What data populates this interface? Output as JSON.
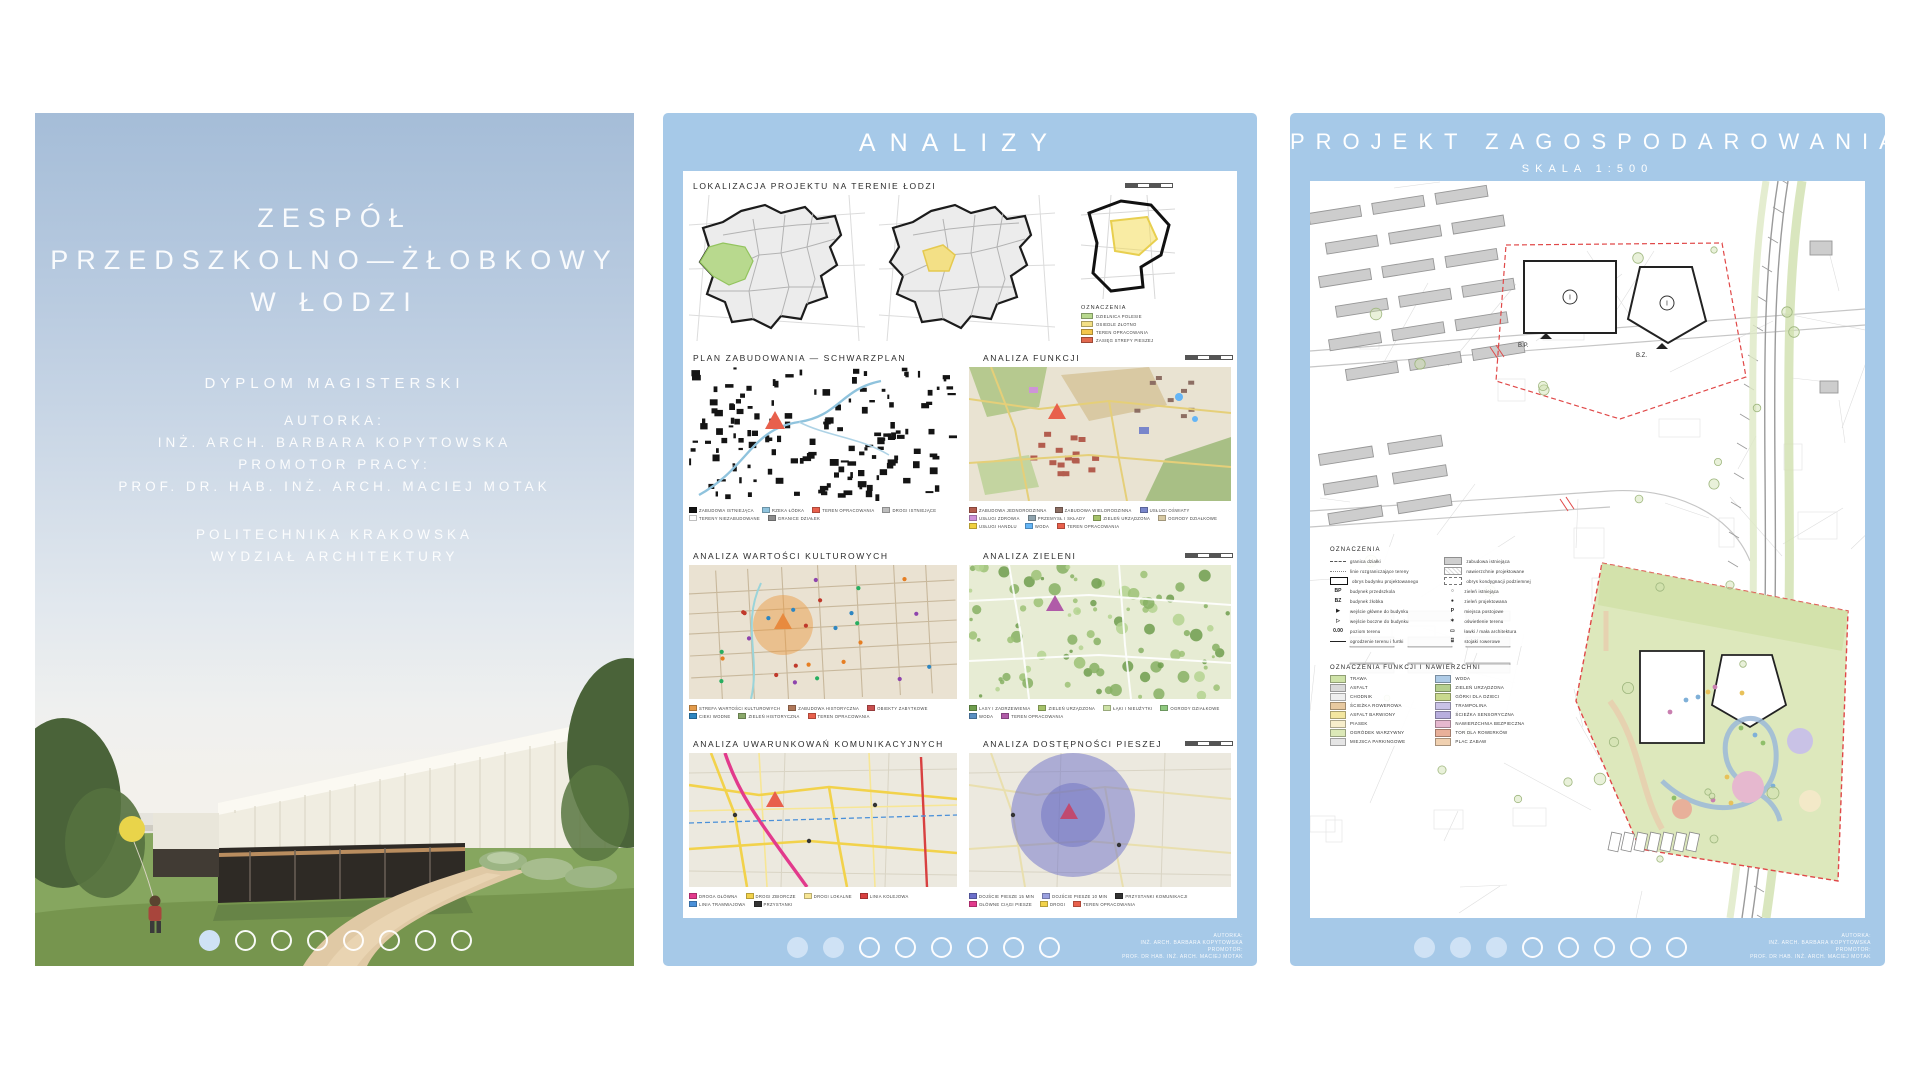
{
  "app": {
    "accent_blue": "#a6c9e8",
    "dot_active": "#cfe2f5",
    "paper": "#ffffff"
  },
  "pagination": {
    "count": 8
  },
  "board1": {
    "title_lines": [
      "ZESPÓŁ",
      "PRZEDSZKOLNO—ŻŁOBKOWY",
      "W ŁODZI"
    ],
    "degree": "DYPLOM MAGISTERSKI",
    "author_label": "AUTORKA:",
    "author": "INŻ. ARCH. BARBARA KOPYTOWSKA",
    "promoter_label": "PROMOTOR PRACY:",
    "promoter": "PROF. DR. HAB. INŻ. ARCH. MACIEJ MOTAK",
    "university": "POLITECHNIKA KRAKOWSKA",
    "faculty": "WYDZIAŁ ARCHITEKTURY",
    "page": 1
  },
  "board2": {
    "title": "ANALIZY",
    "page": 2,
    "loc": {
      "title": "LOKALIZACJA PROJEKTU NA TERENIE ŁODZI",
      "legend_title": "OZNACZENIA",
      "legend": [
        {
          "c": "#b8d98e",
          "t": "DZIELNICA POLESIE"
        },
        {
          "c": "#f3e086",
          "t": "OSIEDLE ZŁOTNO"
        },
        {
          "c": "#f4c64d",
          "t": "TEREN OPRACOWANIA"
        },
        {
          "c": "#e2694f",
          "t": "ZASIĘG STREFY PIESZEJ"
        }
      ]
    },
    "maps": [
      {
        "title": "PLAN ZABUDOWANIA — SCHWARZPLAN",
        "legend": [
          {
            "c": "#141414",
            "t": "ZABUDOWA ISTNIEJĄCA"
          },
          {
            "c": "#8fc3dd",
            "t": "RZEKA ŁÓDKA"
          },
          {
            "c": "#e8604c",
            "t": "TEREN OPRACOWANIA"
          },
          {
            "c": "#bdbdbd",
            "t": "DROGI ISTNIEJĄCE"
          },
          {
            "c": "#ffffff",
            "t": "TERENY NIEZABUDOWANE"
          },
          {
            "c": "#8d8d8d",
            "t": "GRANICE DZIAŁEK"
          }
        ]
      },
      {
        "title": "ANALIZA FUNKCJI",
        "legend": [
          {
            "c": "#b35d4e",
            "t": "ZABUDOWA JEDNORODZINNA"
          },
          {
            "c": "#8d6e63",
            "t": "ZABUDOWA WIELORODZINNA"
          },
          {
            "c": "#7986cb",
            "t": "USŁUGI OŚWIATY"
          },
          {
            "c": "#ce93d8",
            "t": "USŁUGI ZDROWIA"
          },
          {
            "c": "#90a4ae",
            "t": "PRZEMYSŁ I SKŁADY"
          },
          {
            "c": "#a5c26a",
            "t": "ZIELEŃ URZĄDZONA"
          },
          {
            "c": "#d7c9a3",
            "t": "OGRODY DZIAŁKOWE"
          },
          {
            "c": "#f0d040",
            "t": "USŁUGI HANDLU"
          },
          {
            "c": "#64b5f6",
            "t": "WODA"
          },
          {
            "c": "#e8604c",
            "t": "TEREN OPRACOWANIA"
          }
        ]
      },
      {
        "title": "ANALIZA WARTOŚCI KULTUROWYCH",
        "legend": [
          {
            "c": "#e39b4b",
            "t": "STREFA WARTOŚCI KULTUROWYCH"
          },
          {
            "c": "#b0785a",
            "t": "ZABUDOWA HISTORYCZNA"
          },
          {
            "c": "#c94f4f",
            "t": "OBIEKTY ZABYTKOWE"
          },
          {
            "c": "#2e86c1",
            "t": "CIEKI WODNE"
          },
          {
            "c": "#8aa86a",
            "t": "ZIELEŃ HISTORYCZNA"
          },
          {
            "c": "#e8604c",
            "t": "TEREN OPRACOWANIA"
          }
        ]
      },
      {
        "title": "ANALIZA ZIELENI",
        "legend": [
          {
            "c": "#6f9e4d",
            "t": "LASY I ZADRZEWIENIA"
          },
          {
            "c": "#a5c26a",
            "t": "ZIELEŃ URZĄDZONA"
          },
          {
            "c": "#cde2a6",
            "t": "ŁĄKI I NIEUŻYTKI"
          },
          {
            "c": "#8fc97f",
            "t": "OGRODY DZIAŁKOWE"
          },
          {
            "c": "#5a8fc2",
            "t": "WODA"
          },
          {
            "c": "#b05ba8",
            "t": "TEREN OPRACOWANIA"
          }
        ]
      },
      {
        "title": "ANALIZA UWARUNKOWAŃ KOMUNIKACYJNYCH",
        "legend": [
          {
            "c": "#e23a8c",
            "t": "DROGA GŁÓWNA"
          },
          {
            "c": "#f2d24b",
            "t": "DROGI ZBIORCZE"
          },
          {
            "c": "#f7e695",
            "t": "DROGI LOKALNE"
          },
          {
            "c": "#d84040",
            "t": "LINIA KOLEJOWA"
          },
          {
            "c": "#4a90d9",
            "t": "LINIA TRAMWAJOWA"
          },
          {
            "c": "#333333",
            "t": "PRZYSTANKI"
          }
        ]
      },
      {
        "title": "ANALIZA DOSTĘPNOŚCI PIESZEJ",
        "legend": [
          {
            "c": "#6c70ca",
            "t": "DOJŚCIE PIESZE 15 MIN"
          },
          {
            "c": "#9aa0e0",
            "t": "DOJŚCIE PIESZE 10 MIN"
          },
          {
            "c": "#333333",
            "t": "PRZYSTANKI KOMUNIKACJI"
          },
          {
            "c": "#e23a8c",
            "t": "GŁÓWNE CIĄGI PIESZE"
          },
          {
            "c": "#f2d24b",
            "t": "DROGI"
          },
          {
            "c": "#e8604c",
            "t": "TEREN OPRACOWANIA"
          }
        ]
      }
    ],
    "credits": [
      "AUTORKA:",
      "INŻ. ARCH. BARBARA KOPYTOWSKA",
      "PROMOTOR:",
      "PROF. DR HAB. INŻ. ARCH. MACIEJ MOTAK"
    ]
  },
  "board3": {
    "title": "PROJEKT ZAGOSPODAROWANIA TERENU",
    "subtitle": "SKALA 1:500",
    "page": 3,
    "legend_title": "OZNACZENIA",
    "legend_sym": {
      "col1": [
        {
          "s": "l-dash",
          "t": "granica działki"
        },
        {
          "s": "l-dashdot",
          "t": "linie rozgraniczające tereny"
        },
        {
          "s": "b-rect",
          "t": "obrys budynku projektowanego"
        },
        {
          "s": "BP",
          "t": "budynek przedszkola"
        },
        {
          "s": "BZ",
          "t": "budynek żłobka"
        },
        {
          "s": "tri",
          "t": "wejście główne do budynku"
        },
        {
          "s": "trio",
          "t": "wejście boczne do budynku"
        },
        {
          "s": "0.00",
          "t": "poziom terenu"
        },
        {
          "s": "l-solid",
          "t": "ogrodzenie terenu i furtki"
        }
      ],
      "col2": [
        {
          "s": "b-grect",
          "t": "zabudowa istniejąca"
        },
        {
          "s": "b-hrect",
          "t": "nawierzchnie projektowane"
        },
        {
          "s": "b-drect",
          "t": "obrys kondygnacji podziemnej"
        },
        {
          "s": "circo",
          "t": "zieleń istniejąca"
        },
        {
          "s": "circ",
          "t": "zieleń projektowana"
        },
        {
          "s": "P",
          "t": "miejsca postojowe"
        },
        {
          "s": "lamp",
          "t": "oświetlenie terenu"
        },
        {
          "s": "bench",
          "t": "ławki / mała architektura"
        },
        {
          "s": "bike",
          "t": "stojaki rowerowe"
        }
      ]
    },
    "surfaces_title": "OZNACZENIA FUNKCJI I NAWIERZCHNI",
    "surfaces": {
      "col1": [
        {
          "c": "#cfe3a8",
          "t": "TRAWA"
        },
        {
          "c": "#d9d9d9",
          "t": "ASFALT"
        },
        {
          "c": "#efefef",
          "t": "CHODNIK"
        },
        {
          "c": "#e8c9a0",
          "t": "ŚCIEŻKA ROWEROWA"
        },
        {
          "c": "#f3e6a0",
          "t": "ASFALT BARWIONY"
        },
        {
          "c": "#f7eecb",
          "t": "PIASEK"
        },
        {
          "c": "#dce9b8",
          "t": "OGRÓDEK WARZYWNY"
        },
        {
          "c": "#e5e5e5",
          "t": "MIEJSCA PARKINGOWE"
        }
      ],
      "col2": [
        {
          "c": "#aecbe6",
          "t": "WODA"
        },
        {
          "c": "#b5cf8e",
          "t": "ZIELEŃ URZĄDZONA"
        },
        {
          "c": "#c9d98e",
          "t": "GÓRKI DLA DZIECI"
        },
        {
          "c": "#c9c2e6",
          "t": "TRAMPOLINA"
        },
        {
          "c": "#b8aede",
          "t": "ŚCIEŻKA SENSORYCZNA"
        },
        {
          "c": "#e6b8cf",
          "t": "NAWIERZCHNIA BEZPIECZNA"
        },
        {
          "c": "#e8b09a",
          "t": "TOR DLA ROWERKÓW"
        },
        {
          "c": "#f0d0b0",
          "t": "PLAC ZABAW"
        }
      ]
    },
    "credits": [
      "AUTORKA:",
      "INŻ. ARCH. BARBARA KOPYTOWSKA",
      "PROMOTOR:",
      "PROF. DR HAB. INŻ. ARCH. MACIEJ MOTAK"
    ]
  }
}
